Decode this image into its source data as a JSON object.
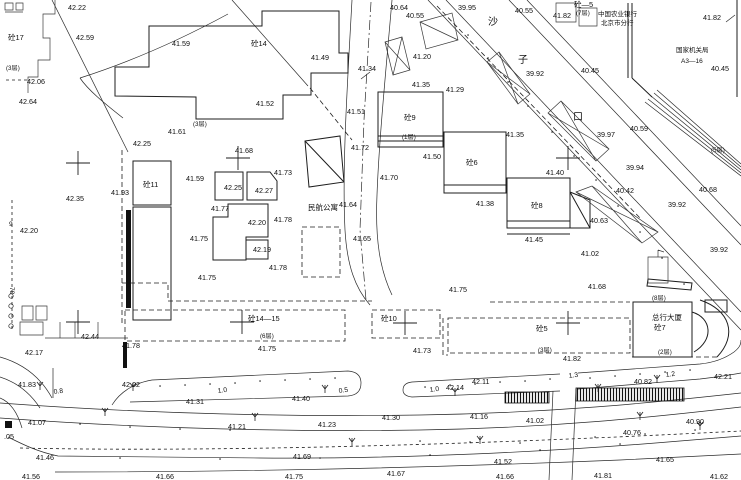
{
  "meta": {
    "title": "城市地形测绘图 (topographic survey plan)",
    "canvas": {
      "width": 741,
      "height": 480
    },
    "colors": {
      "ink": "#1e1e1e",
      "background": "#ffffff"
    }
  },
  "labels": {
    "spot_elevations": [
      {
        "x": 68,
        "y": 10,
        "t": "42.22"
      },
      {
        "x": 76,
        "y": 40,
        "t": "42.59"
      },
      {
        "x": 172,
        "y": 46,
        "t": "41.59"
      },
      {
        "x": 27,
        "y": 84,
        "t": "42.06"
      },
      {
        "x": 19,
        "y": 104,
        "t": "42.64"
      },
      {
        "x": 168,
        "y": 134,
        "t": "41.61"
      },
      {
        "x": 133,
        "y": 146,
        "t": "42.25"
      },
      {
        "x": 390,
        "y": 10,
        "t": "40.64"
      },
      {
        "x": 406,
        "y": 18,
        "t": "40.55"
      },
      {
        "x": 458,
        "y": 10,
        "t": "39.95"
      },
      {
        "x": 311,
        "y": 60,
        "t": "41.49"
      },
      {
        "x": 413,
        "y": 59,
        "t": "41.20"
      },
      {
        "x": 358,
        "y": 71,
        "t": "41.34"
      },
      {
        "x": 412,
        "y": 87,
        "t": "41.35"
      },
      {
        "x": 446,
        "y": 92,
        "t": "41.29"
      },
      {
        "x": 256,
        "y": 106,
        "t": "41.52"
      },
      {
        "x": 347,
        "y": 114,
        "t": "41.51"
      },
      {
        "x": 351,
        "y": 150,
        "t": "41.72"
      },
      {
        "x": 423,
        "y": 159,
        "t": "41.50"
      },
      {
        "x": 515,
        "y": 13,
        "t": "40.55"
      },
      {
        "x": 553,
        "y": 18,
        "t": "41.82"
      },
      {
        "x": 703,
        "y": 20,
        "t": "41.82"
      },
      {
        "x": 526,
        "y": 76,
        "t": "39.92"
      },
      {
        "x": 581,
        "y": 73,
        "t": "40.45"
      },
      {
        "x": 711,
        "y": 71,
        "t": "40.45"
      },
      {
        "x": 630,
        "y": 131,
        "t": "40.59"
      },
      {
        "x": 597,
        "y": 137,
        "t": "39.97"
      },
      {
        "x": 506,
        "y": 137,
        "t": "41.35"
      },
      {
        "x": 626,
        "y": 170,
        "t": "39.94"
      },
      {
        "x": 616,
        "y": 193,
        "t": "40.42"
      },
      {
        "x": 699,
        "y": 192,
        "t": "40.68"
      },
      {
        "x": 668,
        "y": 207,
        "t": "39.92"
      },
      {
        "x": 710,
        "y": 252,
        "t": "39.92"
      },
      {
        "x": 66,
        "y": 201,
        "t": "42.35"
      },
      {
        "x": 20,
        "y": 233,
        "t": "42.20"
      },
      {
        "x": 111,
        "y": 195,
        "t": "41.93"
      },
      {
        "x": 186,
        "y": 181,
        "t": "41.59"
      },
      {
        "x": 224,
        "y": 190,
        "t": "42.25"
      },
      {
        "x": 255,
        "y": 193,
        "t": "42.27"
      },
      {
        "x": 235,
        "y": 153,
        "t": "41.68"
      },
      {
        "x": 274,
        "y": 175,
        "t": "41.73"
      },
      {
        "x": 211,
        "y": 211,
        "t": "41.77"
      },
      {
        "x": 248,
        "y": 225,
        "t": "42.20"
      },
      {
        "x": 274,
        "y": 222,
        "t": "41.78"
      },
      {
        "x": 253,
        "y": 252,
        "t": "42.19"
      },
      {
        "x": 269,
        "y": 270,
        "t": "41.78"
      },
      {
        "x": 190,
        "y": 241,
        "t": "41.75"
      },
      {
        "x": 198,
        "y": 280,
        "t": "41.75"
      },
      {
        "x": 339,
        "y": 207,
        "t": "41.64"
      },
      {
        "x": 353,
        "y": 241,
        "t": "41.65"
      },
      {
        "x": 380,
        "y": 180,
        "t": "41.70"
      },
      {
        "x": 546,
        "y": 175,
        "t": "41.40"
      },
      {
        "x": 476,
        "y": 206,
        "t": "41.38"
      },
      {
        "x": 590,
        "y": 223,
        "t": "40.63"
      },
      {
        "x": 525,
        "y": 242,
        "t": "41.45"
      },
      {
        "x": 581,
        "y": 256,
        "t": "41.02"
      },
      {
        "x": 588,
        "y": 289,
        "t": "41.68"
      },
      {
        "x": 449,
        "y": 292,
        "t": "41.75"
      },
      {
        "x": 81,
        "y": 339,
        "t": "42.44"
      },
      {
        "x": 25,
        "y": 355,
        "t": "42.17"
      },
      {
        "x": 122,
        "y": 348,
        "t": "41.78"
      },
      {
        "x": 18,
        "y": 387,
        "t": "41.83"
      },
      {
        "x": 122,
        "y": 387,
        "t": "42.02"
      },
      {
        "x": 186,
        "y": 404,
        "t": "41.31"
      },
      {
        "x": 28,
        "y": 425,
        "t": "41.07"
      },
      {
        "x": 228,
        "y": 429,
        "t": "41.21"
      },
      {
        "x": 4,
        "y": 439,
        "t": ".05"
      },
      {
        "x": 36,
        "y": 460,
        "t": "41.46"
      },
      {
        "x": 258,
        "y": 351,
        "t": "41.75"
      },
      {
        "x": 413,
        "y": 353,
        "t": "41.73"
      },
      {
        "x": 472,
        "y": 384,
        "t": "42.11"
      },
      {
        "x": 446,
        "y": 390,
        "t": "42.14"
      },
      {
        "x": 292,
        "y": 401,
        "t": "41.40"
      },
      {
        "x": 382,
        "y": 420,
        "t": "41.30"
      },
      {
        "x": 470,
        "y": 419,
        "t": "41.16"
      },
      {
        "x": 318,
        "y": 427,
        "t": "41.23"
      },
      {
        "x": 293,
        "y": 459,
        "t": "41.69"
      },
      {
        "x": 563,
        "y": 361,
        "t": "41.82"
      },
      {
        "x": 714,
        "y": 379,
        "t": "42.21"
      },
      {
        "x": 634,
        "y": 384,
        "t": "40.82"
      },
      {
        "x": 526,
        "y": 423,
        "t": "41.02"
      },
      {
        "x": 686,
        "y": 424,
        "t": "40.90"
      },
      {
        "x": 623,
        "y": 435,
        "t": "40.76"
      },
      {
        "x": 494,
        "y": 464,
        "t": "41.52"
      },
      {
        "x": 656,
        "y": 462,
        "t": "41.65"
      },
      {
        "x": 22,
        "y": 479,
        "t": "41.56"
      },
      {
        "x": 156,
        "y": 479,
        "t": "41.66"
      },
      {
        "x": 285,
        "y": 479,
        "t": "41.75"
      },
      {
        "x": 387,
        "y": 476,
        "t": "41.67"
      },
      {
        "x": 496,
        "y": 479,
        "t": "41.66"
      },
      {
        "x": 594,
        "y": 478,
        "t": "41.81"
      },
      {
        "x": 710,
        "y": 479,
        "t": "41.62"
      }
    ],
    "building_labels": [
      {
        "x": 8,
        "y": 40,
        "t": "砼17"
      },
      {
        "x": 251,
        "y": 46,
        "t": "砼14"
      },
      {
        "x": 404,
        "y": 120,
        "t": "砼9"
      },
      {
        "x": 143,
        "y": 187,
        "t": "砼11"
      },
      {
        "x": 466,
        "y": 165,
        "t": "砼6"
      },
      {
        "x": 531,
        "y": 208,
        "t": "砼8"
      },
      {
        "x": 248,
        "y": 321,
        "t": "砼14—15"
      },
      {
        "x": 381,
        "y": 321,
        "t": "砼10"
      },
      {
        "x": 536,
        "y": 331,
        "t": "砼5"
      },
      {
        "x": 654,
        "y": 330,
        "t": "砼7"
      },
      {
        "x": 574,
        "y": 7,
        "t": "砼—5"
      }
    ],
    "floor_notes": [
      {
        "x": 6,
        "y": 70,
        "t": "(3层)"
      },
      {
        "x": 193,
        "y": 126,
        "t": "(3层)"
      },
      {
        "x": 402,
        "y": 139,
        "t": "(1层)"
      },
      {
        "x": 576,
        "y": 15,
        "t": "(7层)"
      },
      {
        "x": 711,
        "y": 152,
        "t": "(5层)"
      },
      {
        "x": 260,
        "y": 338,
        "t": "(6层)"
      },
      {
        "x": 538,
        "y": 352,
        "t": "(3层)"
      },
      {
        "x": 658,
        "y": 354,
        "t": "(2层)"
      },
      {
        "x": 652,
        "y": 300,
        "t": "(8层)"
      }
    ],
    "place_names": [
      {
        "x": 308,
        "y": 210,
        "t": "民航公寓"
      },
      {
        "x": 652,
        "y": 320,
        "t": "总行大厦"
      }
    ],
    "small_names": [
      {
        "x": 598,
        "y": 16,
        "t": "中国农业银行"
      },
      {
        "x": 601,
        "y": 25,
        "t": "北京市分行"
      },
      {
        "x": 676,
        "y": 52,
        "t": "国家机关局"
      },
      {
        "x": 681,
        "y": 63,
        "t": "A3—16"
      }
    ],
    "street_name_chars": [
      {
        "x": 488,
        "y": 25,
        "t": "沙"
      },
      {
        "x": 518,
        "y": 63,
        "t": "子"
      },
      {
        "x": 573,
        "y": 120,
        "t": "口"
      }
    ],
    "road_widths": [
      {
        "x": 54,
        "y": 394,
        "t": "0.8",
        "r": -8
      },
      {
        "x": 218,
        "y": 393,
        "t": "1.0",
        "r": -8
      },
      {
        "x": 339,
        "y": 393,
        "t": "0.5",
        "r": -8
      },
      {
        "x": 430,
        "y": 392,
        "t": "1.0",
        "r": -8
      },
      {
        "x": 569,
        "y": 378,
        "t": "1.3",
        "r": -8
      },
      {
        "x": 666,
        "y": 377,
        "t": "1.2",
        "r": -8
      }
    ],
    "misc": [
      {
        "x": 9,
        "y": 226,
        "t": "9"
      },
      {
        "x": 10,
        "y": 287,
        "t": "78",
        "r": 90
      }
    ]
  }
}
